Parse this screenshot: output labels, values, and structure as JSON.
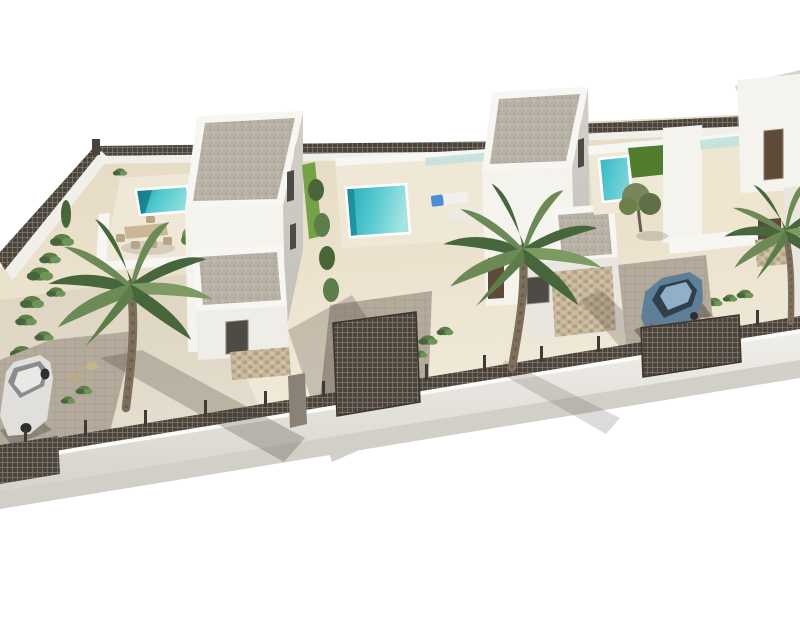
{
  "scene": {
    "kind": "3d-architectural-render",
    "description": "Aerial isometric 3D rendering of a walled residential plot with three modern white two-storey villas, flat gravel roofs, private turquoise pools, palm trees, mesh perimeter fence and two parked cars, on a plain white background",
    "counts": {
      "villas": 3,
      "pools": 3,
      "palm_trees": 3,
      "cars": 2,
      "gates": 3
    }
  },
  "palette": {
    "background": "#ffffff",
    "sand": "#eadfc9",
    "terrace": "#f0e8d6",
    "deck_light": "#efe6d2",
    "paver": "#b4ab9d",
    "street": "#d2cfc8",
    "wall_lit": "#f5f3ee",
    "wall_mid": "#efede7",
    "wall_shade": "#e9e6df",
    "wall_face_right": "#cfccc5",
    "parapet": "#f7f6f2",
    "coping": "#fbfbf9",
    "fence_white": "#f1efe9",
    "mesh_dark": "#4b443c",
    "mesh_light": "#857c6f",
    "gravel": "#b8b1a6",
    "stone": "#c6b69c",
    "pool_dark": "#16808e",
    "pool_mid": "#4cc7cd",
    "pool_light": "#8fdede",
    "lawn": "#517d2f",
    "hedge_bright": "#73a346",
    "hedge_dark": "#4a6638",
    "palm_frond": "#6b8a56",
    "palm_frond_dark": "#47663c",
    "palm_trunk": "#7d6f5c",
    "olive": "#77875a",
    "wood_door": "#5d4a38",
    "window_dark": "#4e4a45",
    "glass_rail": "#bfe0dd",
    "lounger": "#f2f0ea",
    "towel": "#4a8fd4",
    "table": "#cbb795",
    "chair": "#b7a584",
    "pot": "#9a6b4f",
    "car_white_body": "#e0dfdc",
    "car_white_glass": "#898d90",
    "car_blue_body": "#5e7f97",
    "car_blue_glass": "#2f3f4b",
    "car_blue_roof": "#8fb0c6",
    "taillight": "#c23b2d",
    "wheel": "#2e2e2e"
  }
}
